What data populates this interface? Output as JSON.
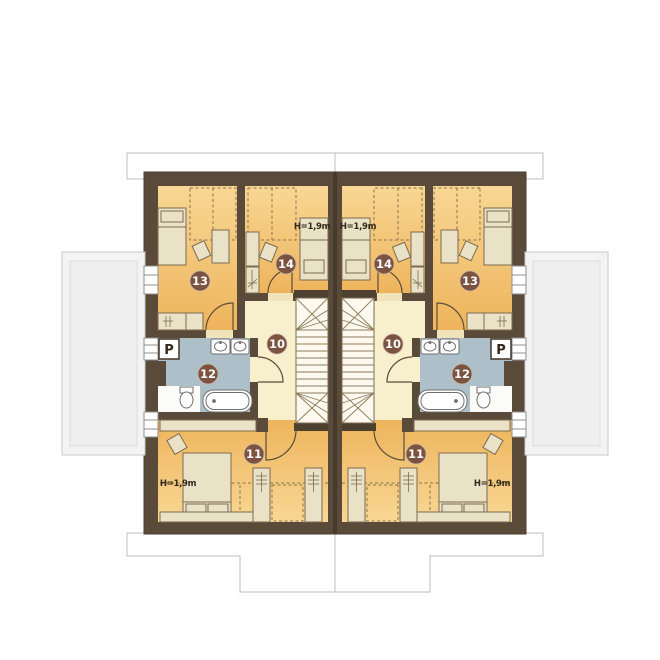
{
  "plan": {
    "rooms": {
      "hall": "10",
      "bedroom_bottom": "11",
      "bathroom": "12",
      "bedroom_corner": "13",
      "bedroom_middle": "14"
    },
    "height_label": "H=1,9m",
    "parapet_label": "P",
    "colors": {
      "wall": "#5a4a3a",
      "wall_seam": "#463a2c",
      "room_orange": "#f2bd66",
      "room_orange_light": "#f8d794",
      "hall": "#f8efcd",
      "stairs": "#fdf9ee",
      "bathroom": "#adc0c9",
      "bath_niche": "#fbfbf8",
      "furniture": "#eae2c7",
      "furniture_stroke": "#7c6b50",
      "fixture_white": "#ffffff",
      "outside_gray": "#f3f3f3",
      "outline_gray": "#bdbdbd",
      "badge": "#7b5340",
      "badge_text": "#ffffff",
      "label_text": "#33271a",
      "dashed_line": "#8a7450"
    }
  }
}
